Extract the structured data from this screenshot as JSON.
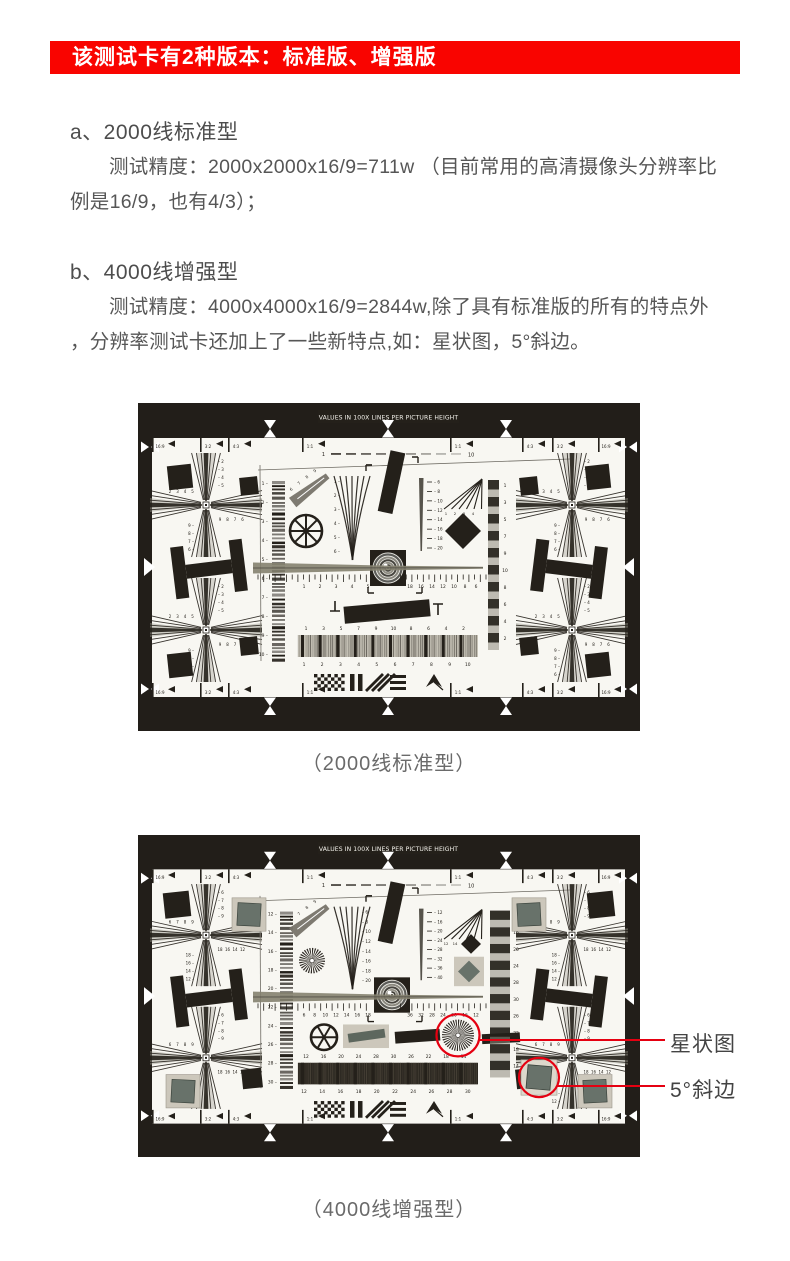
{
  "banner": {
    "text": "该测试卡有2种版本：标准版、增强版",
    "bg": "#f90400",
    "fg": "#ffffff"
  },
  "sections": {
    "a": {
      "heading": "a、2000线标准型",
      "body": "测试精度：2000x2000x16/9=711w （目前常用的高清摄像头分辨率比\n例是16/9，也有4/3）；"
    },
    "b": {
      "heading": "b、4000线增强型",
      "body": "测试精度：4000x4000x16/9=2844w,除了具有标准版的所有的特点外\n，分辨率测试卡还加上了一些新特点,如：星状图，5°斜边。"
    }
  },
  "figures": {
    "standard": {
      "caption": "（2000线标准型）",
      "title_bar": "VALUES IN 100X LINES PER PICTURE HEIGHT",
      "aspect_labels": [
        "16:9",
        "3:2",
        "4:3",
        "1:1",
        "1:1",
        "4:3",
        "3:2",
        "16:9"
      ],
      "dash_ends": [
        "1",
        "10"
      ],
      "scales": {
        "leftScale": [
          "1",
          "2",
          "3",
          "4",
          "5",
          "6",
          "7",
          "8",
          "9",
          "10"
        ],
        "wedgeLeft": [
          "1",
          "2",
          "3",
          "4",
          "5",
          "6"
        ],
        "wedgeRight": [
          "6",
          "8",
          "10",
          "12",
          "14",
          "16",
          "18",
          "20"
        ],
        "fanNums": [
          "1",
          "2",
          "3",
          "4"
        ],
        "rulerLeft": [
          "1",
          "2",
          "3",
          "4",
          "5"
        ],
        "rulerRight": [
          "18",
          "16",
          "14",
          "12",
          "10",
          "8",
          "6"
        ],
        "rightCol": [
          "1",
          "3",
          "5",
          "7",
          "9",
          "10",
          "8",
          "6",
          "4",
          "2"
        ],
        "bandTop": [
          "1",
          "3",
          "5",
          "7",
          "9",
          "10",
          "8",
          "6",
          "4",
          "2"
        ],
        "bandBottom": [
          "1",
          "2",
          "3",
          "4",
          "5",
          "6",
          "7",
          "8",
          "9",
          "10"
        ],
        "crossTop": [
          "2",
          "3",
          "4",
          "5"
        ],
        "crossBottom": [
          "9",
          "8",
          "7",
          "6"
        ]
      }
    },
    "enhanced": {
      "caption": "（4000线增强型）",
      "title_bar": "VALUES IN 100X LINES PER PICTURE HEIGHT",
      "aspect_labels": [
        "16:9",
        "3:2",
        "4:3",
        "1:1",
        "1:1",
        "4:3",
        "3:2",
        "16:9"
      ],
      "dash_ends": [
        "1",
        "10"
      ],
      "scales": {
        "leftScale": [
          "12",
          "14",
          "16",
          "18",
          "20",
          "22",
          "24",
          "26",
          "28",
          "30"
        ],
        "wedgeLeft": [
          "6",
          "8",
          "10",
          "12",
          "14",
          "16",
          "18",
          "20"
        ],
        "wedgeRight": [
          "12",
          "16",
          "20",
          "24",
          "28",
          "32",
          "36",
          "40"
        ],
        "fanNums": [
          "12",
          "14",
          "16",
          "18"
        ],
        "rulerLeft": [
          "6",
          "8",
          "10",
          "12",
          "14",
          "16",
          "18"
        ],
        "rulerRight": [
          "36",
          "32",
          "28",
          "24",
          "20",
          "16",
          "12"
        ],
        "rightCol": [
          "12",
          "16",
          "20",
          "24",
          "28",
          "30",
          "26",
          "22",
          "18",
          "14"
        ],
        "bandTop": [
          "12",
          "16",
          "20",
          "24",
          "28",
          "30",
          "26",
          "22",
          "18",
          "14"
        ],
        "bandBottom": [
          "12",
          "14",
          "16",
          "18",
          "20",
          "22",
          "24",
          "26",
          "28",
          "30"
        ],
        "crossTop": [
          "6",
          "7",
          "8",
          "9"
        ],
        "crossBottom": [
          "18",
          "16",
          "14",
          "12"
        ]
      },
      "annotations": [
        {
          "label": "星状图"
        },
        {
          "label": "5°斜边"
        }
      ]
    }
  },
  "colors": {
    "chart_frame": "#221e19",
    "chart_paper": "#f8f7f2",
    "chart_ink": "#24201a",
    "green_patch": "#68726a",
    "patch_frame": "#ccc7bb",
    "annotation_red": "#e50011"
  }
}
